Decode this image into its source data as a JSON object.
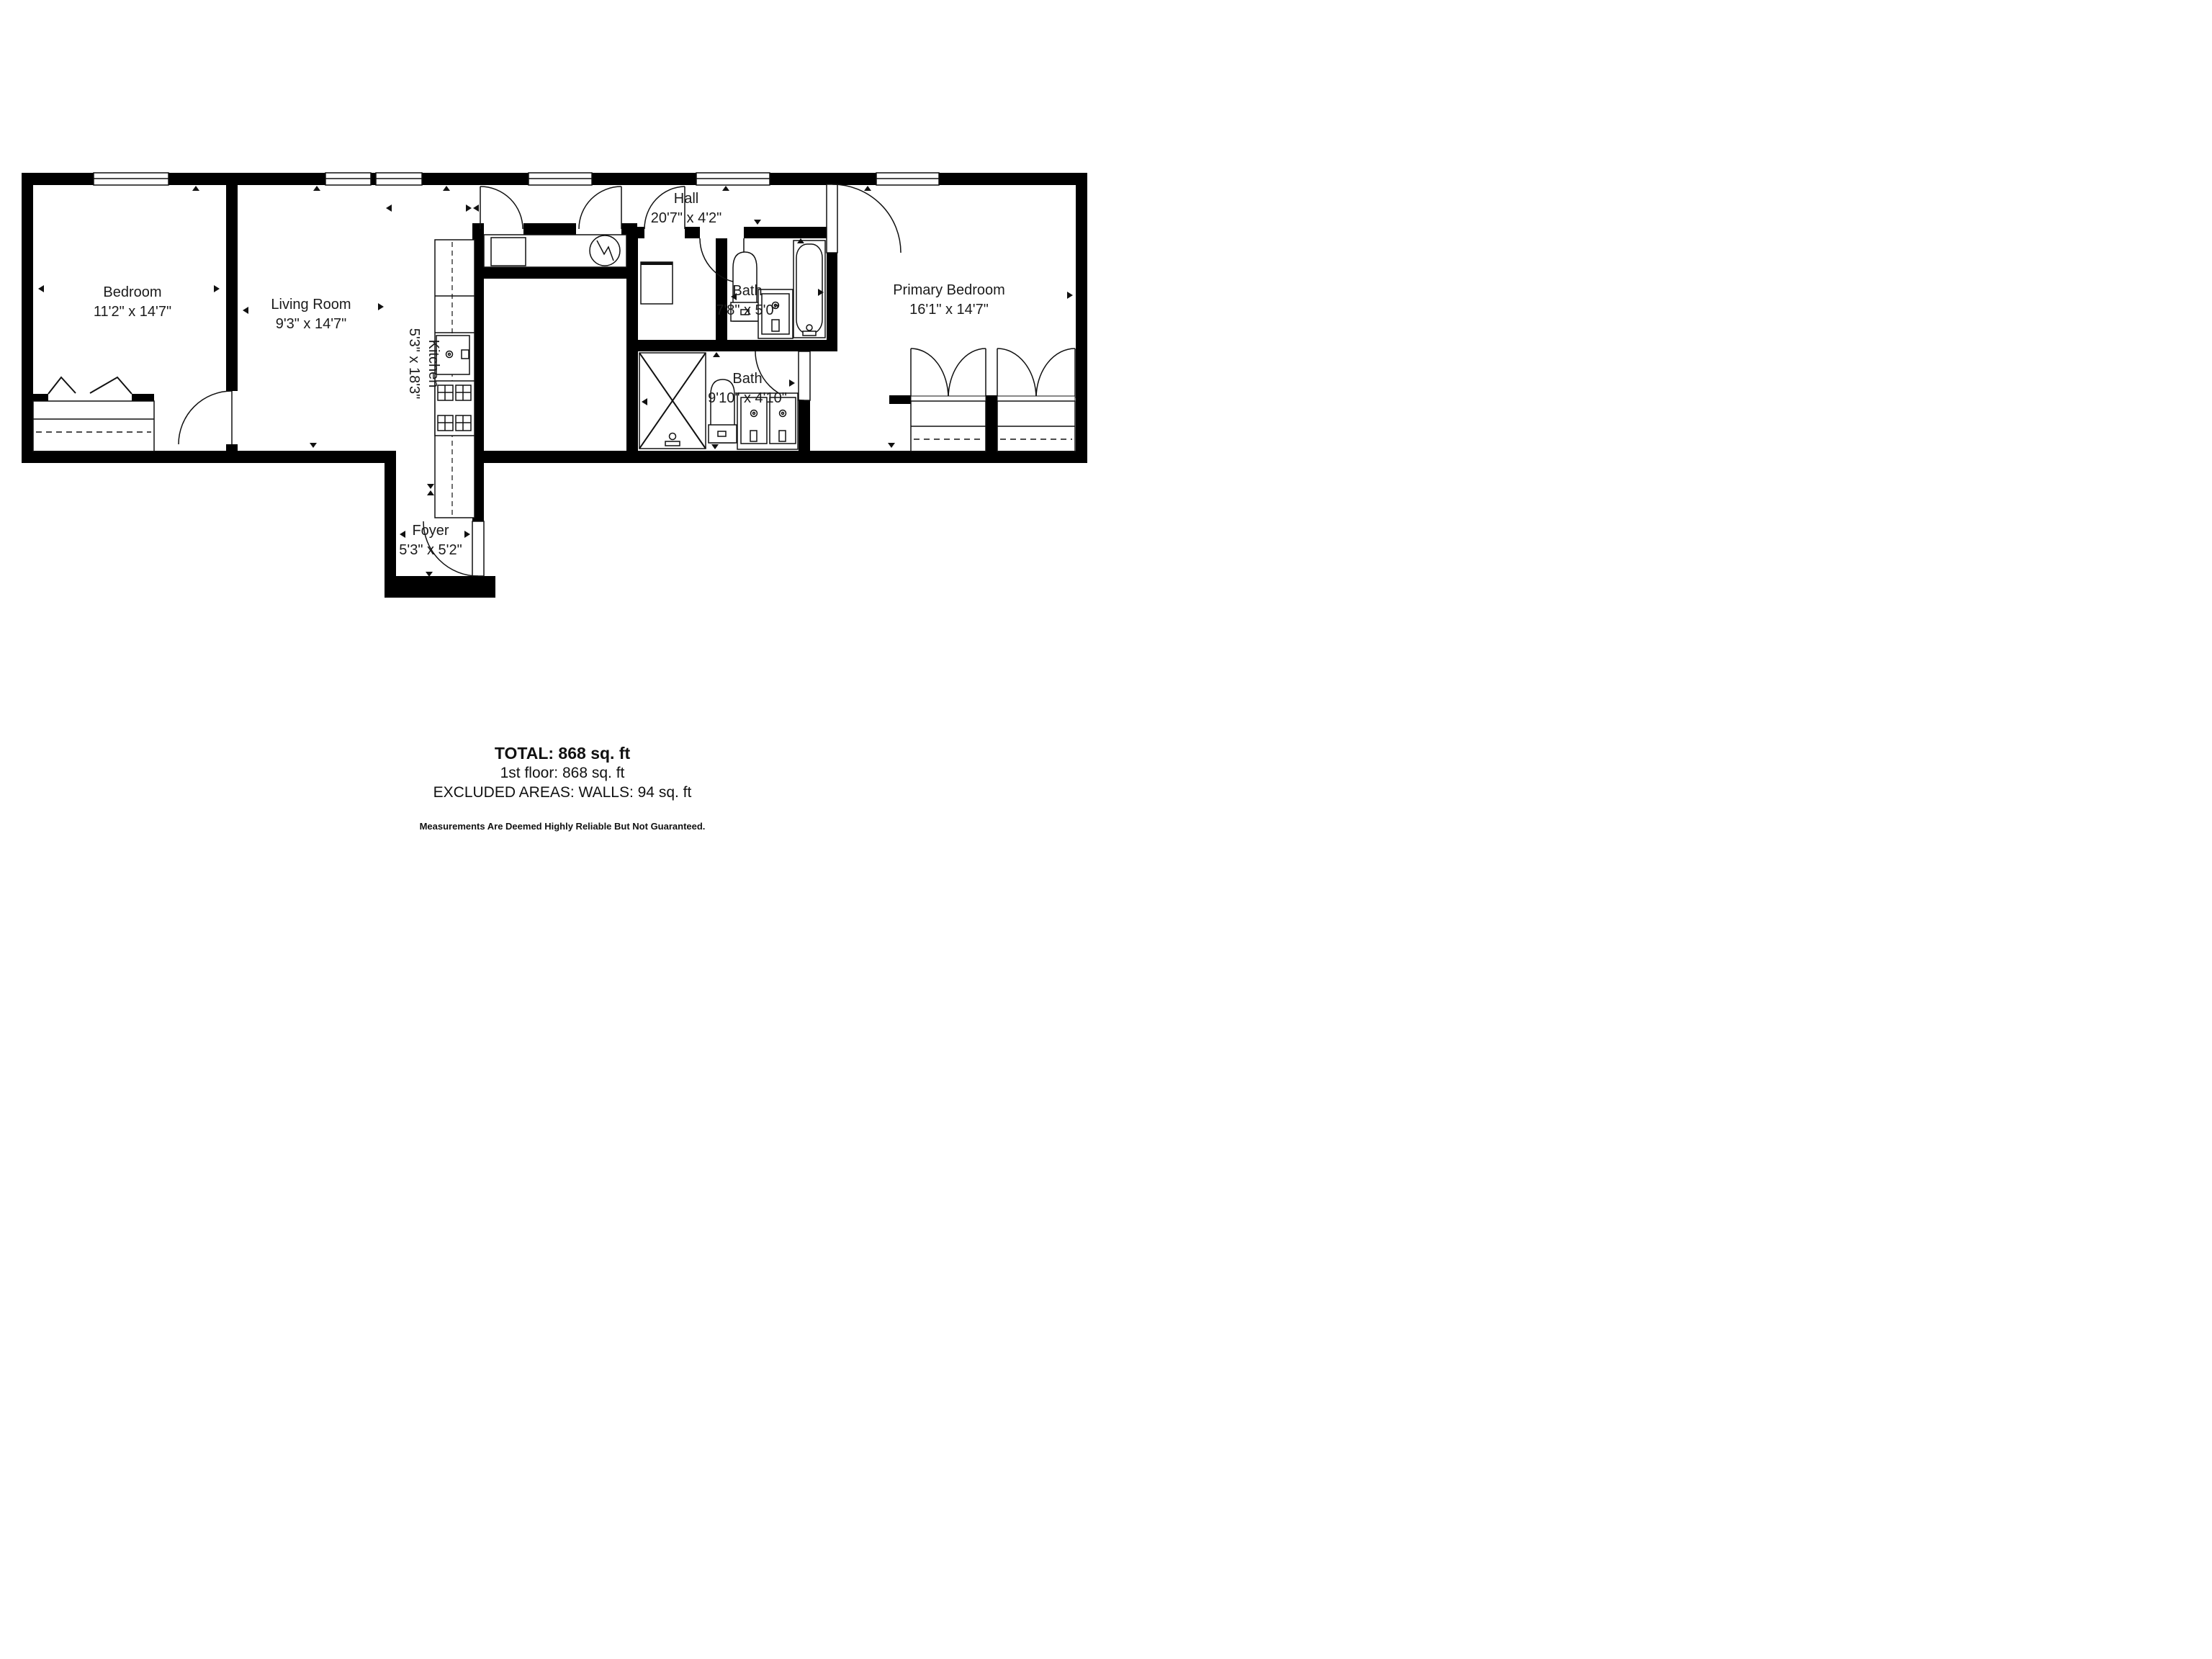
{
  "rooms": [
    {
      "id": "bedroom",
      "name": "Bedroom",
      "dims": "11'2\" x 14'7\""
    },
    {
      "id": "living-room",
      "name": "Living Room",
      "dims": "9'3\" x 14'7\""
    },
    {
      "id": "kitchen",
      "name": "Kitchen",
      "dims": "5'3\" x 18'3\""
    },
    {
      "id": "hall",
      "name": "Hall",
      "dims": "20'7\" x 4'2\""
    },
    {
      "id": "bath-upper",
      "name": "Bath",
      "dims": "7'8\" x 5'0\""
    },
    {
      "id": "bath-lower",
      "name": "Bath",
      "dims": "9'10\" x 4'10\""
    },
    {
      "id": "primary-bedroom",
      "name": "Primary Bedroom",
      "dims": "16'1\" x 14'7\""
    },
    {
      "id": "foyer",
      "name": "Foyer",
      "dims": "5'3\" x 5'2\""
    }
  ],
  "summary": {
    "total": "TOTAL: 868 sq. ft",
    "floor1": "1st floor: 868 sq. ft",
    "excluded": "EXCLUDED AREAS: WALLS: 94 sq. ft",
    "disclaimer": "Measurements Are Deemed Highly Reliable But Not Guaranteed."
  },
  "fixtures": [
    "refrigerator",
    "water-heater",
    "kitchen-sink",
    "stove",
    "washer",
    "toilet",
    "bathtub",
    "vanity-sink",
    "shower",
    "double-vanity",
    "bifold-closet",
    "double-door-closet",
    "window",
    "door-swing"
  ],
  "colors": {
    "wall": "#000000",
    "line": "#111111",
    "background": "#ffffff",
    "text": "#1b1b1b"
  }
}
